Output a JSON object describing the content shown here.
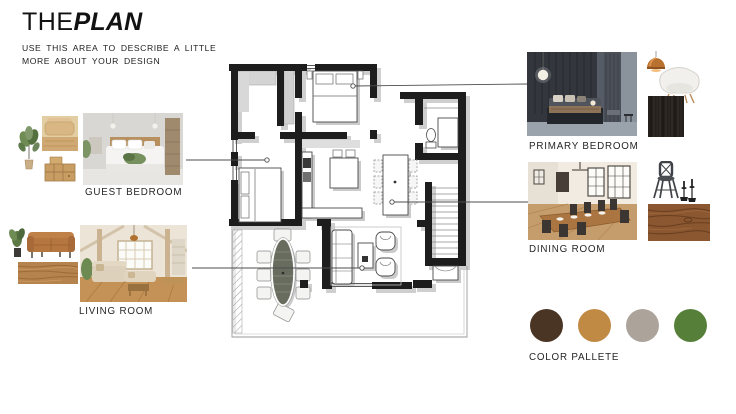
{
  "header": {
    "title_regular": "THE",
    "title_bold": "PLAN",
    "subtitle_line1": "USE THIS AREA TO DESCRIBE A LITTLE",
    "subtitle_line2": "MORE ABOUT YOUR DESIGN"
  },
  "labels": {
    "guest_bedroom": "GUEST BEDROOM",
    "living_room": "LIVING ROOM",
    "primary_bedroom": "PRIMARY BEDROOM",
    "dining_room": "DINING ROOM",
    "color_palette": "COLOR PALLETE"
  },
  "palette": {
    "colors": [
      "#4a3424",
      "#c08a45",
      "#aca49b",
      "#56803a"
    ]
  },
  "colors": {
    "plan_wall": "#1d1d1d",
    "plan_shadow": "#c7c7c7",
    "leader_line": "#4d4d4d"
  }
}
